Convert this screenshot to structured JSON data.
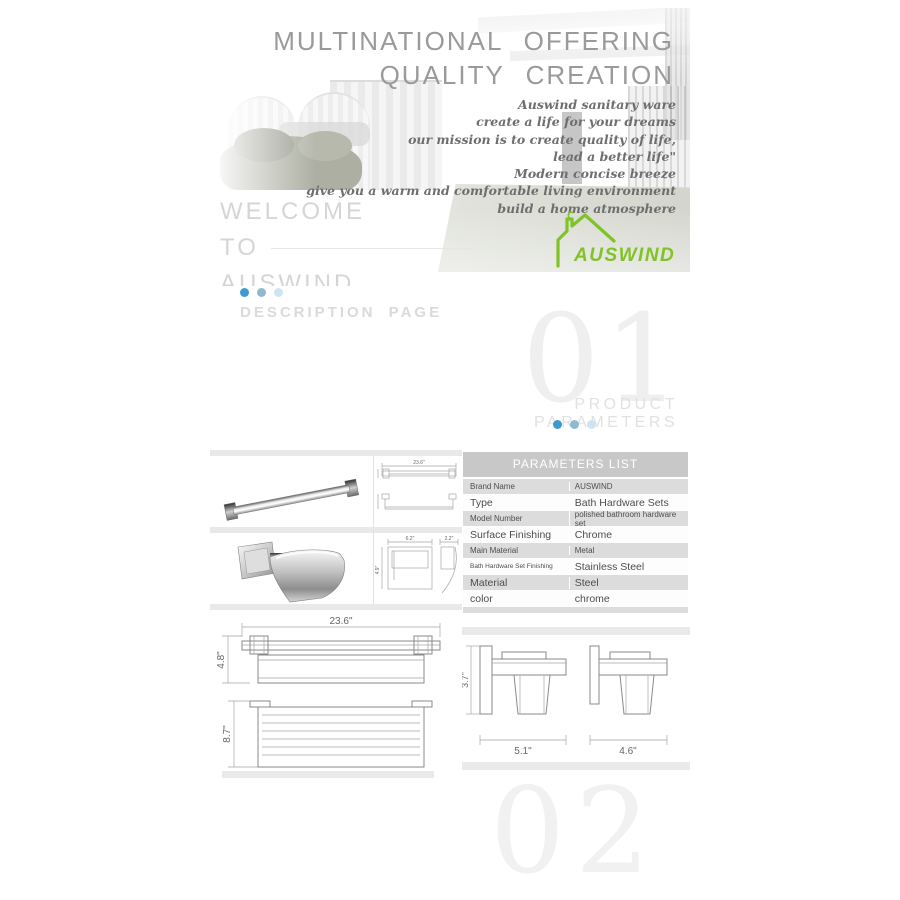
{
  "banner": {
    "headline": [
      "MULTINATIONAL OFFERING",
      "QUALITY CREATION"
    ],
    "script_lines": [
      "Auswind sanitary ware",
      "create a life for your dreams",
      "our mission is to create quality of life,",
      "lead a better life\"",
      "Modern concise breeze",
      "give you a warm and comfortable living environment",
      "build a home atmosphere"
    ],
    "welcome": [
      "WELCOME",
      "TO",
      "AUSWIND"
    ],
    "logo_text": "AUSWIND",
    "logo_color": "#7fc324"
  },
  "pager": {
    "description_label": "DESCRIPTION PAGE"
  },
  "section1": {
    "watermark": "01",
    "title": "PRODUCT PARAMETERS"
  },
  "section2": {
    "watermark": "02"
  },
  "accent_colors": {
    "dot_blue": "#3b9ace",
    "dot_mid": "#8fb9cf",
    "dot_pale": "#cfe4f1"
  },
  "parameters_table": {
    "header": "PARAMETERS LIST",
    "rows": [
      {
        "label": "Brand Name",
        "value": "AUSWIND"
      },
      {
        "label": "Type",
        "value": "Bath Hardware Sets"
      },
      {
        "label": "Model Number",
        "value": "polished bathroom hardware set"
      },
      {
        "label": "Surface Finishing",
        "value": "Chrome"
      },
      {
        "label": "Main Material",
        "value": "Metal"
      },
      {
        "label": "Bath Hardware Set Finishing",
        "value": "Stainless Steel"
      },
      {
        "label": "Material",
        "value": "Steel"
      },
      {
        "label": "color",
        "value": "chrome"
      }
    ]
  },
  "drawings": {
    "towel_bar_small": {
      "width": "23.6\""
    },
    "paper_holder_small": {
      "width": "6.2\"",
      "height": "4.9\"",
      "depth": "2.2\""
    },
    "shelf_front": {
      "width": "23.6\"",
      "height": "4.8\""
    },
    "shelf_top": {
      "depth": "8.7\""
    },
    "side_view_left": {
      "height": "3.7\"",
      "width": "5.1\""
    },
    "side_view_right": {
      "width": "4.6\""
    }
  }
}
